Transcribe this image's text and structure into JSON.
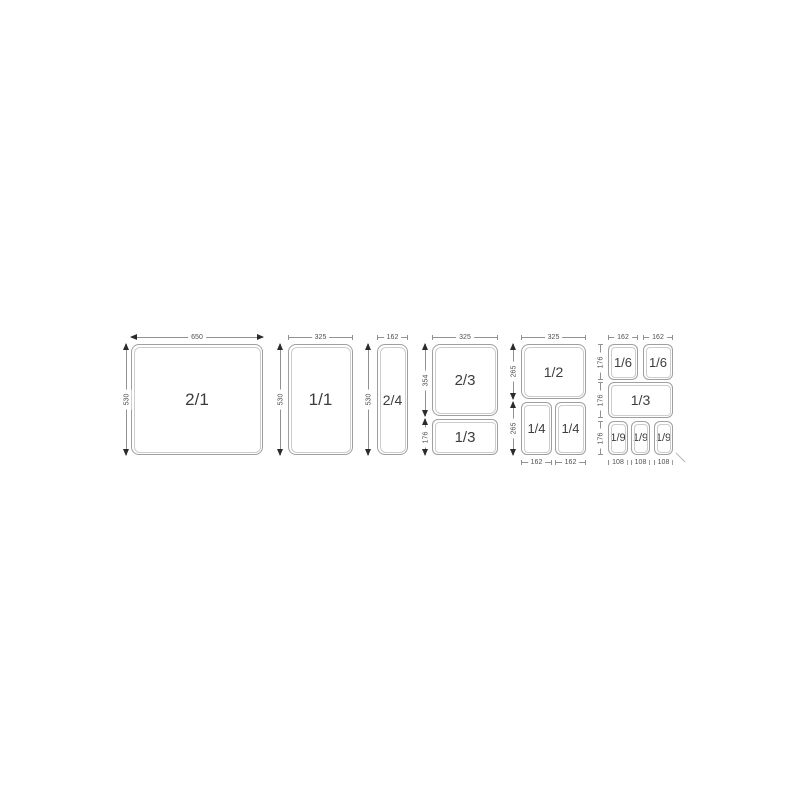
{
  "diagram": {
    "groups": [
      {
        "id": "2-1",
        "pans": [
          {
            "label": "2/1"
          }
        ],
        "dims": {
          "top": [
            "650"
          ],
          "left": [
            "530"
          ]
        }
      },
      {
        "id": "1-1",
        "pans": [
          {
            "label": "1/1"
          }
        ],
        "dims": {
          "top": [
            "325"
          ],
          "left": [
            "530"
          ]
        }
      },
      {
        "id": "2-4",
        "pans": [
          {
            "label": "2/4"
          }
        ],
        "dims": {
          "top": [
            "162"
          ],
          "left": [
            "530"
          ]
        }
      },
      {
        "id": "2-3-and-1-3",
        "pans": [
          {
            "label": "2/3"
          },
          {
            "label": "1/3"
          }
        ],
        "dims": {
          "top": [
            "325"
          ],
          "left": [
            "354",
            "176"
          ]
        }
      },
      {
        "id": "1-2-and-1-4",
        "pans": [
          {
            "label": "1/2"
          },
          {
            "label": "1/4"
          },
          {
            "label": "1/4"
          }
        ],
        "dims": {
          "top": [
            "325"
          ],
          "left": [
            "265",
            "265"
          ],
          "bottom": [
            "162",
            "162"
          ]
        }
      },
      {
        "id": "1-6-1-3-1-9",
        "pans": [
          {
            "label": "1/6"
          },
          {
            "label": "1/6"
          },
          {
            "label": "1/3"
          },
          {
            "label": "1/9"
          },
          {
            "label": "1/9"
          },
          {
            "label": "1/9"
          }
        ],
        "dims": {
          "top": [
            "162",
            "162"
          ],
          "left": [
            "176",
            "176",
            "176"
          ],
          "bottom": [
            "108",
            "108",
            "108"
          ]
        }
      }
    ],
    "colors": {
      "background": "#ffffff",
      "pan_outline": "#9f9f9f",
      "pan_inner_outline": "#cccccc",
      "dim_line": "#919191",
      "arrow": "#2b2b2b",
      "pan_label_text": "#3d3d3d",
      "dim_label_text": "#4f4f4f"
    }
  }
}
